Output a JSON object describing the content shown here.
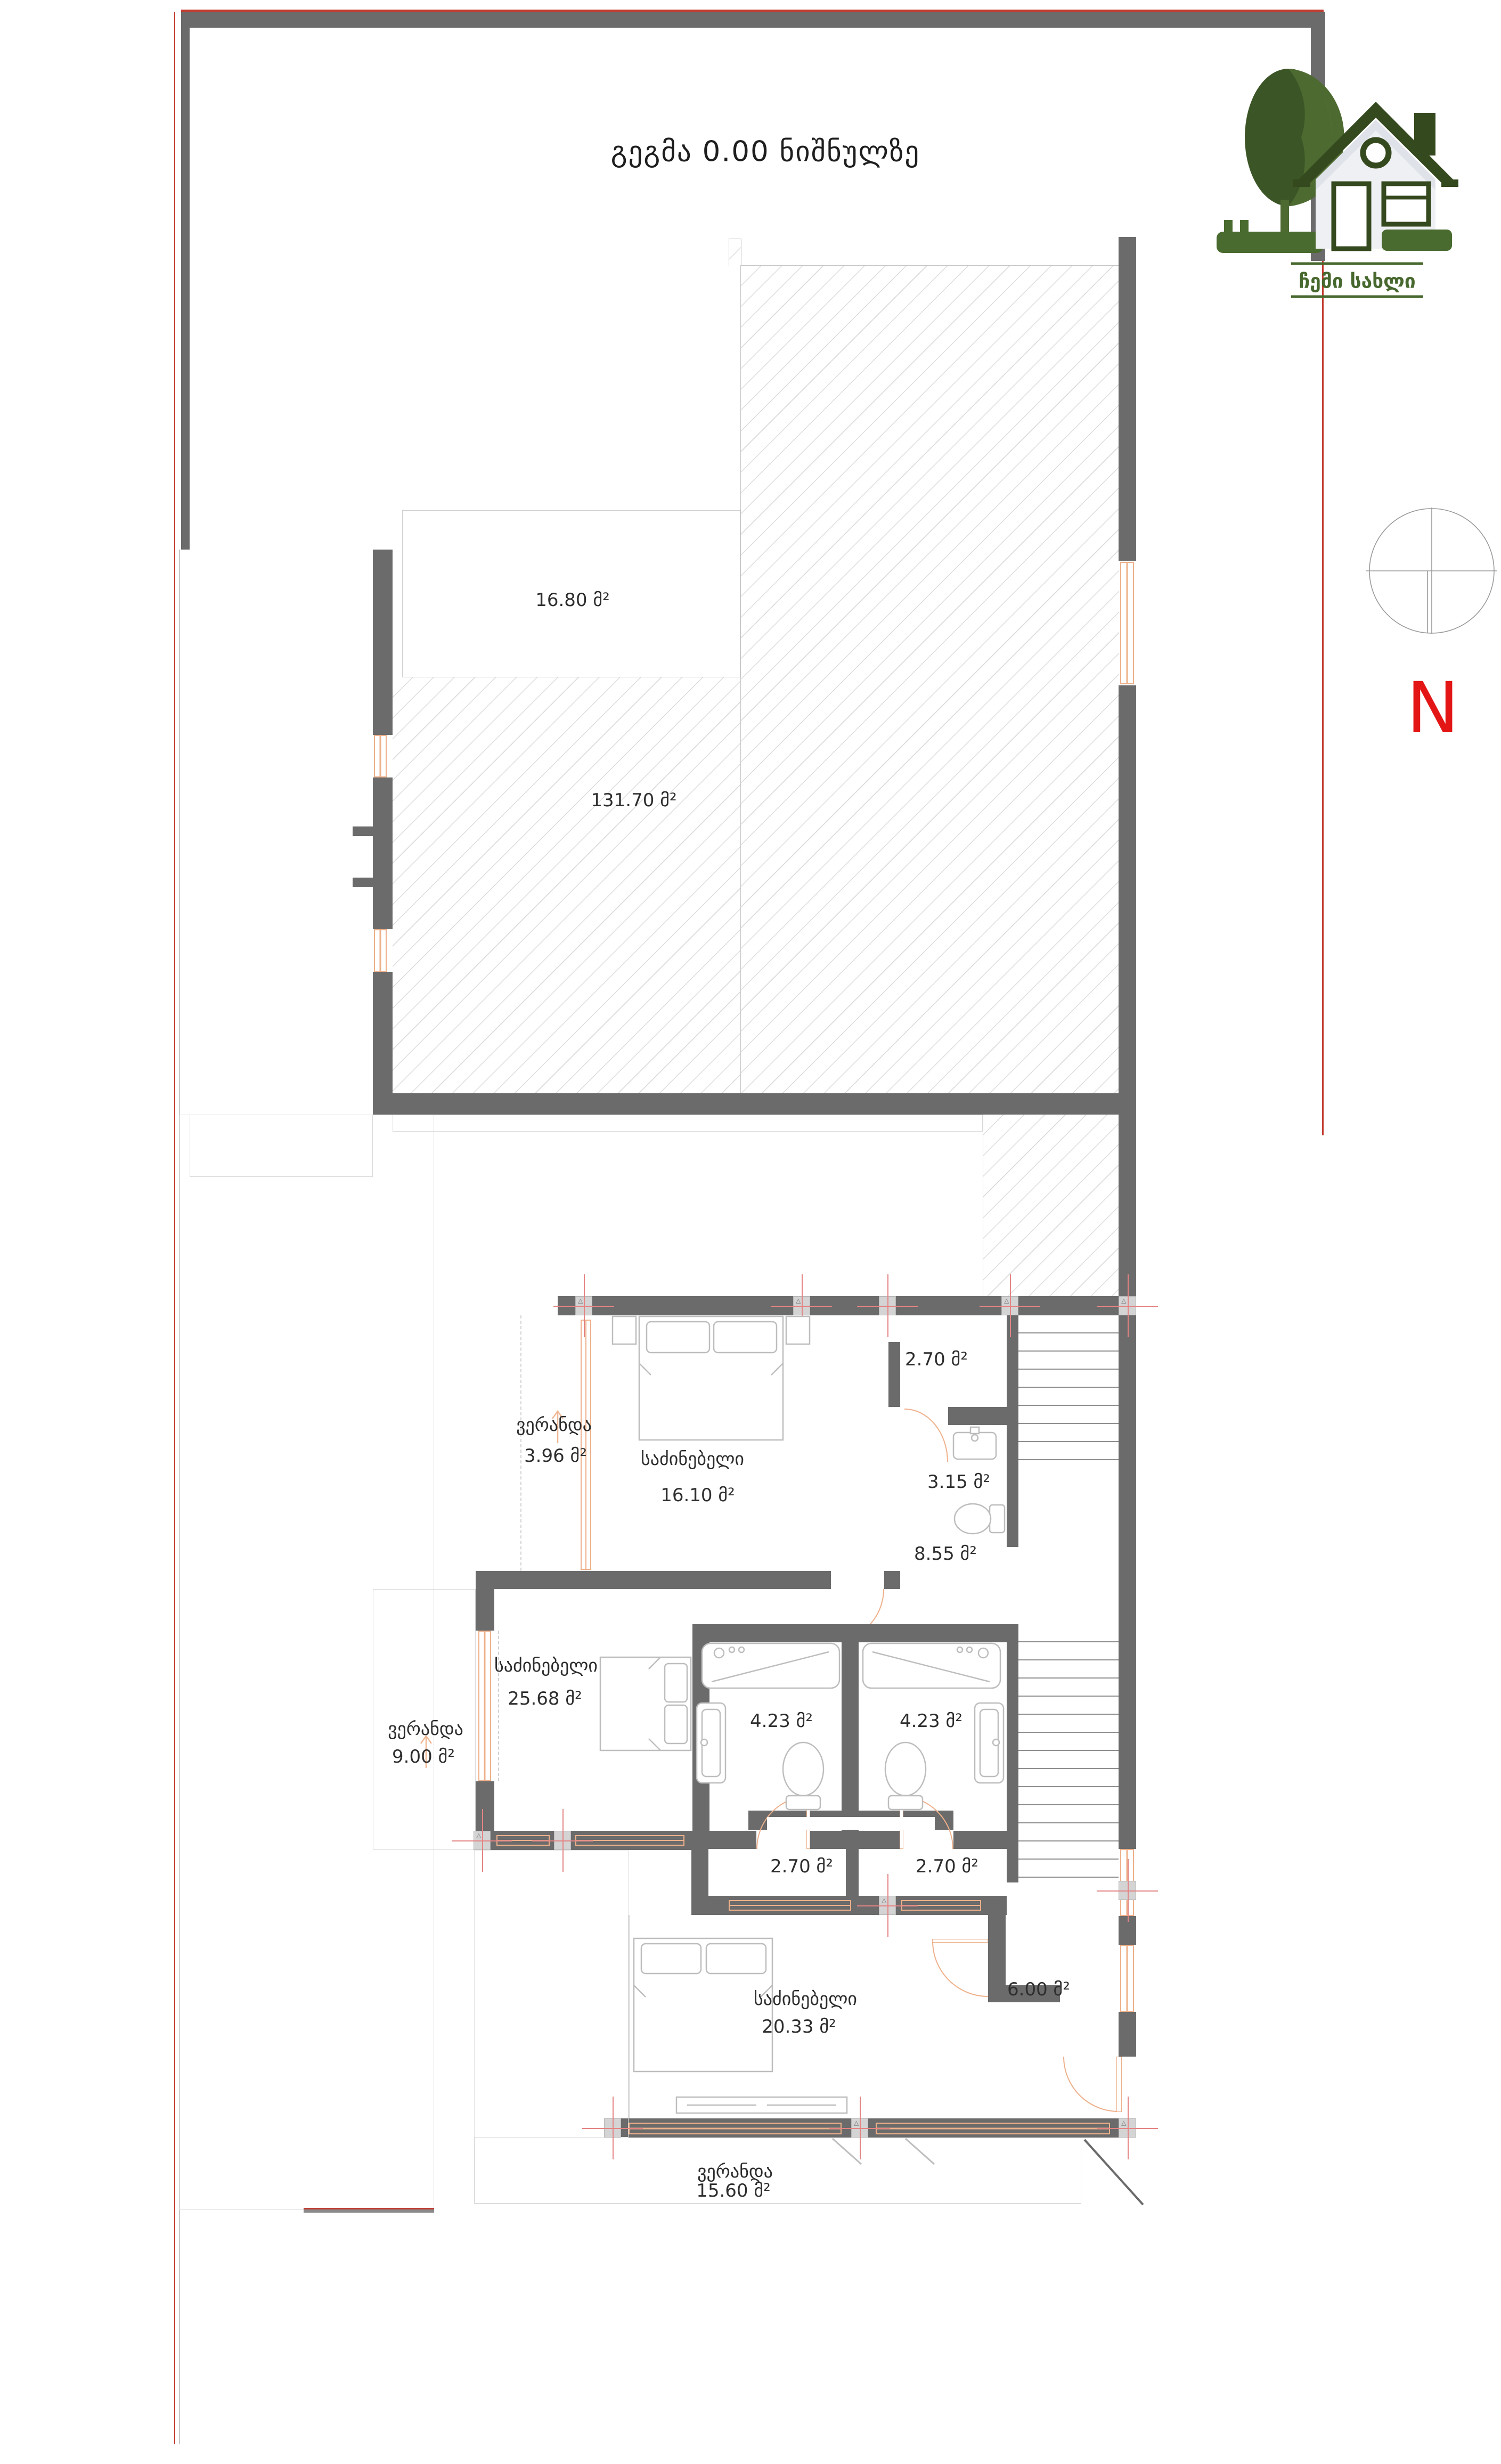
{
  "title": "გეგმა 0.00 ნიშნულზე",
  "logo": {
    "brand": "ჩემი სახლი"
  },
  "compass": {
    "north_label": "N"
  },
  "rooms": {
    "storage_top": {
      "area": "16.80 მ²"
    },
    "terrace": {
      "area": "131.70 მ²"
    },
    "veranda_upper": {
      "name": "ვერანდა",
      "area": "3.96 მ²"
    },
    "bedroom_upper": {
      "name": "საძინებელი",
      "area": "16.10 მ²"
    },
    "wc_upper": {
      "area": "2.70 მ²"
    },
    "bath_upper": {
      "area": "3.15 მ²"
    },
    "hall_upper": {
      "area": "8.55 მ²"
    },
    "bedroom_middle": {
      "name": "საძინებელი",
      "area": "25.68 მ²"
    },
    "veranda_left": {
      "name": "ვერანდა",
      "area": "9.00 მ²"
    },
    "bath_left": {
      "area": "4.23 მ²"
    },
    "bath_right": {
      "area": "4.23 მ²"
    },
    "closet_left": {
      "area": "2.70 მ²"
    },
    "closet_right": {
      "area": "2.70 მ²"
    },
    "bedroom_lower": {
      "name": "საძინებელი",
      "area": "20.33 მ²"
    },
    "hall_entry": {
      "area": "6.00 მ²"
    },
    "veranda_bottom": {
      "name": "ვერანდა",
      "area": "15.60 მ²"
    }
  },
  "colors": {
    "wall": "#6b6b6b",
    "column": "#d4d4d4",
    "window_orange": "#eeb08a",
    "boundary_red": "#c23b2f",
    "north_red": "#e31515",
    "logo_green_dark": "#35491e",
    "logo_green": "#4a6b2f",
    "hatch_line": "#dcdcdc"
  }
}
